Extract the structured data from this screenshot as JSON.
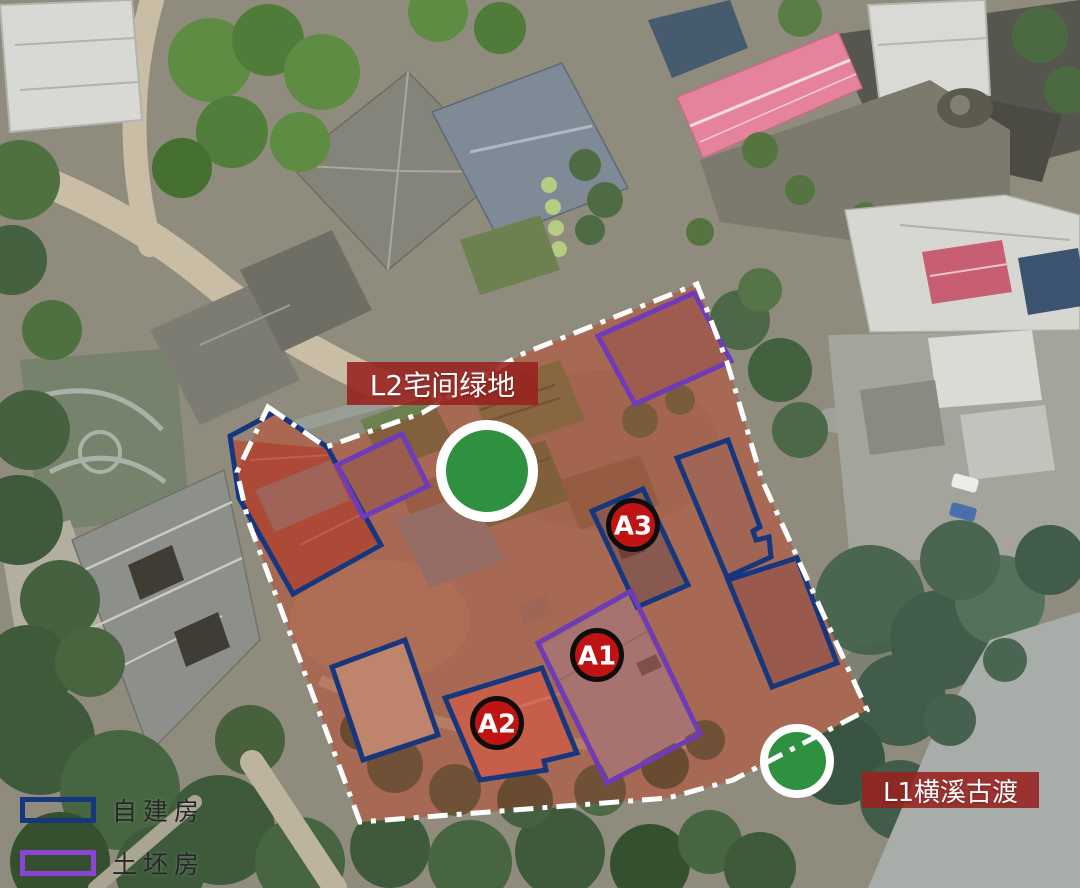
{
  "colors": {
    "self_built_outline": "#16377e",
    "adobe_outline": "#6e3cb8",
    "site_fill": "rgba(168,40,28,0.36)",
    "site_boundary": "#ffffff",
    "marker_ring": "#0d0d0d",
    "marker_fill": "#c01414",
    "marker_text": "#ffffff",
    "green_node_fill": "#2e9140",
    "green_node_ring": "#ffffff",
    "label_box_bg": "rgba(152,33,30,0.88)",
    "label_text": "#ffffff",
    "legend_text": "#272727"
  },
  "legend": {
    "items": [
      {
        "id": "self_built",
        "label": "自建房",
        "swatch_color": "#16377e"
      },
      {
        "id": "adobe",
        "label": "土坯房",
        "swatch_color": "#8a46d2"
      }
    ]
  },
  "area_labels": [
    {
      "id": "L2",
      "text": "L2宅间绿地",
      "x": 347,
      "y": 362,
      "w": 191,
      "h": 43,
      "font": 28
    },
    {
      "id": "L1",
      "text": "L1横溪古渡",
      "x": 862,
      "y": 772,
      "w": 177,
      "h": 36,
      "font": 26
    }
  ],
  "markers": [
    {
      "id": "A1",
      "label": "A1",
      "x": 597,
      "y": 655
    },
    {
      "id": "A2",
      "label": "A2",
      "x": 497,
      "y": 723
    },
    {
      "id": "A3",
      "label": "A3",
      "x": 633,
      "y": 525
    }
  ],
  "green_nodes": [
    {
      "id": "green-node-large",
      "x": 487,
      "y": 471,
      "r": 46,
      "ring": 10
    },
    {
      "id": "green-node-small",
      "x": 797,
      "y": 761,
      "r": 33,
      "ring": 8
    }
  ],
  "site": {
    "points": "268,407 326,447 422,413 520,355 697,284 727,362 762,480 867,710 733,780 668,798 360,822 248,520 237,472"
  },
  "buildings": [
    {
      "type": "self_built",
      "points": "275,412 327,447 381,545 293,594 239,498 230,436",
      "fill": "rgba(200,90,70,0.10)"
    },
    {
      "type": "self_built",
      "points": "592,511 643,489 688,585 637,607",
      "fill": "rgba(140,120,110,0.12)"
    },
    {
      "type": "self_built",
      "points": "677,458 728,440 760,527 753,531 756,540 769,537 771,557 727,577",
      "fill": "rgba(190,130,110,0.12)"
    },
    {
      "type": "self_built",
      "points": "728,580 797,558 837,663 772,687",
      "fill": "rgba(170,110,95,0.12)"
    },
    {
      "type": "self_built",
      "points": "332,667 405,640 438,735 363,760",
      "fill": "rgba(215,185,150,0.18)"
    },
    {
      "type": "self_built",
      "points": "445,698 542,668 577,753 544,761 546,770 480,780",
      "fill": "rgba(235,110,85,0.18)"
    },
    {
      "type": "adobe",
      "points": "337,465 402,434 428,486 363,517",
      "fill": "rgba(180,120,100,0.12)"
    },
    {
      "type": "adobe",
      "points": "598,336 694,293 731,361 635,404",
      "fill": "rgba(200,120,105,0.15)"
    },
    {
      "type": "adobe",
      "points": "538,643 631,591 700,734 607,783",
      "fill": "rgba(175,140,140,0.12)"
    }
  ]
}
